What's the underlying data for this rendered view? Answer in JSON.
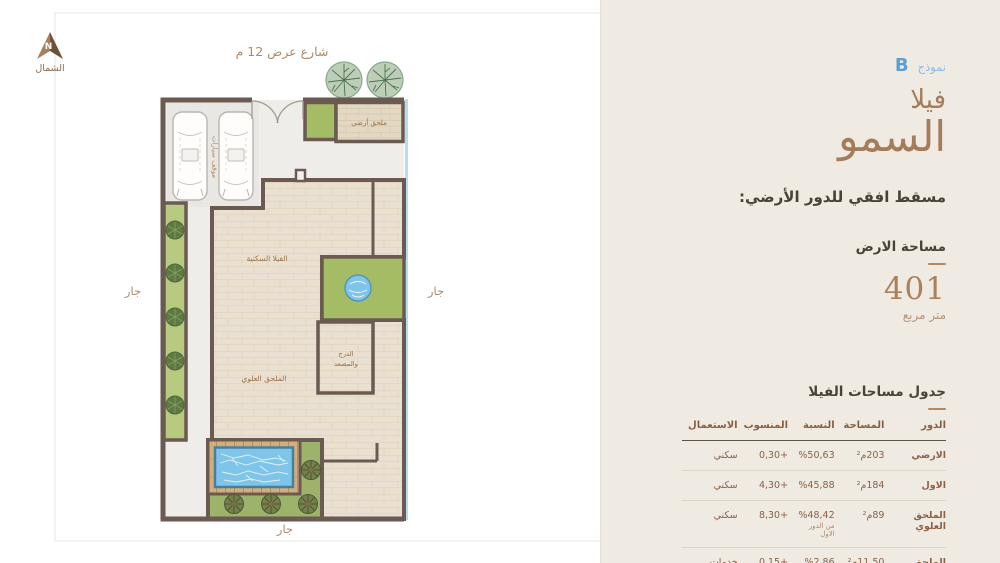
{
  "panel": {
    "model_label": "نموذج",
    "model_letter": "B",
    "title_line1": "فيلا",
    "title_line2": "السمو",
    "subtitle": "مسقط افقي للدور الأرضي:",
    "land_area": {
      "label": "مساحة الارض",
      "value": "401",
      "unit": "متر مربع"
    },
    "table": {
      "title": "جدول مساحات الفيلا",
      "headers": [
        "الدور",
        "المساحة",
        "النسبة",
        "المنسوب",
        "الاستعمال"
      ],
      "rows": [
        {
          "floor": "الارضي",
          "area": "203م²",
          "ratio": "%50,63",
          "ratio_note": "",
          "level": "+0,30",
          "use": "سكني"
        },
        {
          "floor": "الاول",
          "area": "184م²",
          "ratio": "%45,88",
          "ratio_note": "",
          "level": "+4,30",
          "use": "سكني"
        },
        {
          "floor": "الملحق العلوي",
          "area": "89م²",
          "ratio": "%48,42",
          "ratio_note": "من الدور الاول",
          "level": "+8,30",
          "use": "سكني"
        },
        {
          "floor": "الملحق الارضي",
          "area": "11,50م²",
          "ratio": "%2,86",
          "ratio_note": "",
          "level": "+0,15",
          "use": "خدمات"
        }
      ]
    }
  },
  "plan": {
    "street_label": "شارع عرض 12 م",
    "north": {
      "letter": "N",
      "label": "الشمال"
    },
    "neighbor_left": "جار",
    "neighbor_right": "جار",
    "neighbor_bottom": "جار",
    "rooms": {
      "parking": "موقف سيارات",
      "ground_annex": "ملحق أرضي",
      "villa": "الفيلا السكنية",
      "upper_annex": "الملحق العلوي",
      "stairs_line1": "الدرج",
      "stairs_line2": "والمصعد"
    }
  },
  "colors": {
    "panel_bg": "#efeae2",
    "accent_blue": "#5c9ed6",
    "accent_brown": "#a57c59",
    "text_dark": "#4a4238",
    "table_brown": "#8a5f43",
    "wall": "#6b5a51",
    "grass_green": "#a4bd64",
    "strip_green": "#b7ca7f",
    "terrace_green": "#9db26a",
    "pool_blue": "#7fc4e9",
    "deck_tan": "#d4ad7d",
    "wood_floor": "#e9e0d1",
    "boundary_blue": "#b2def0"
  }
}
